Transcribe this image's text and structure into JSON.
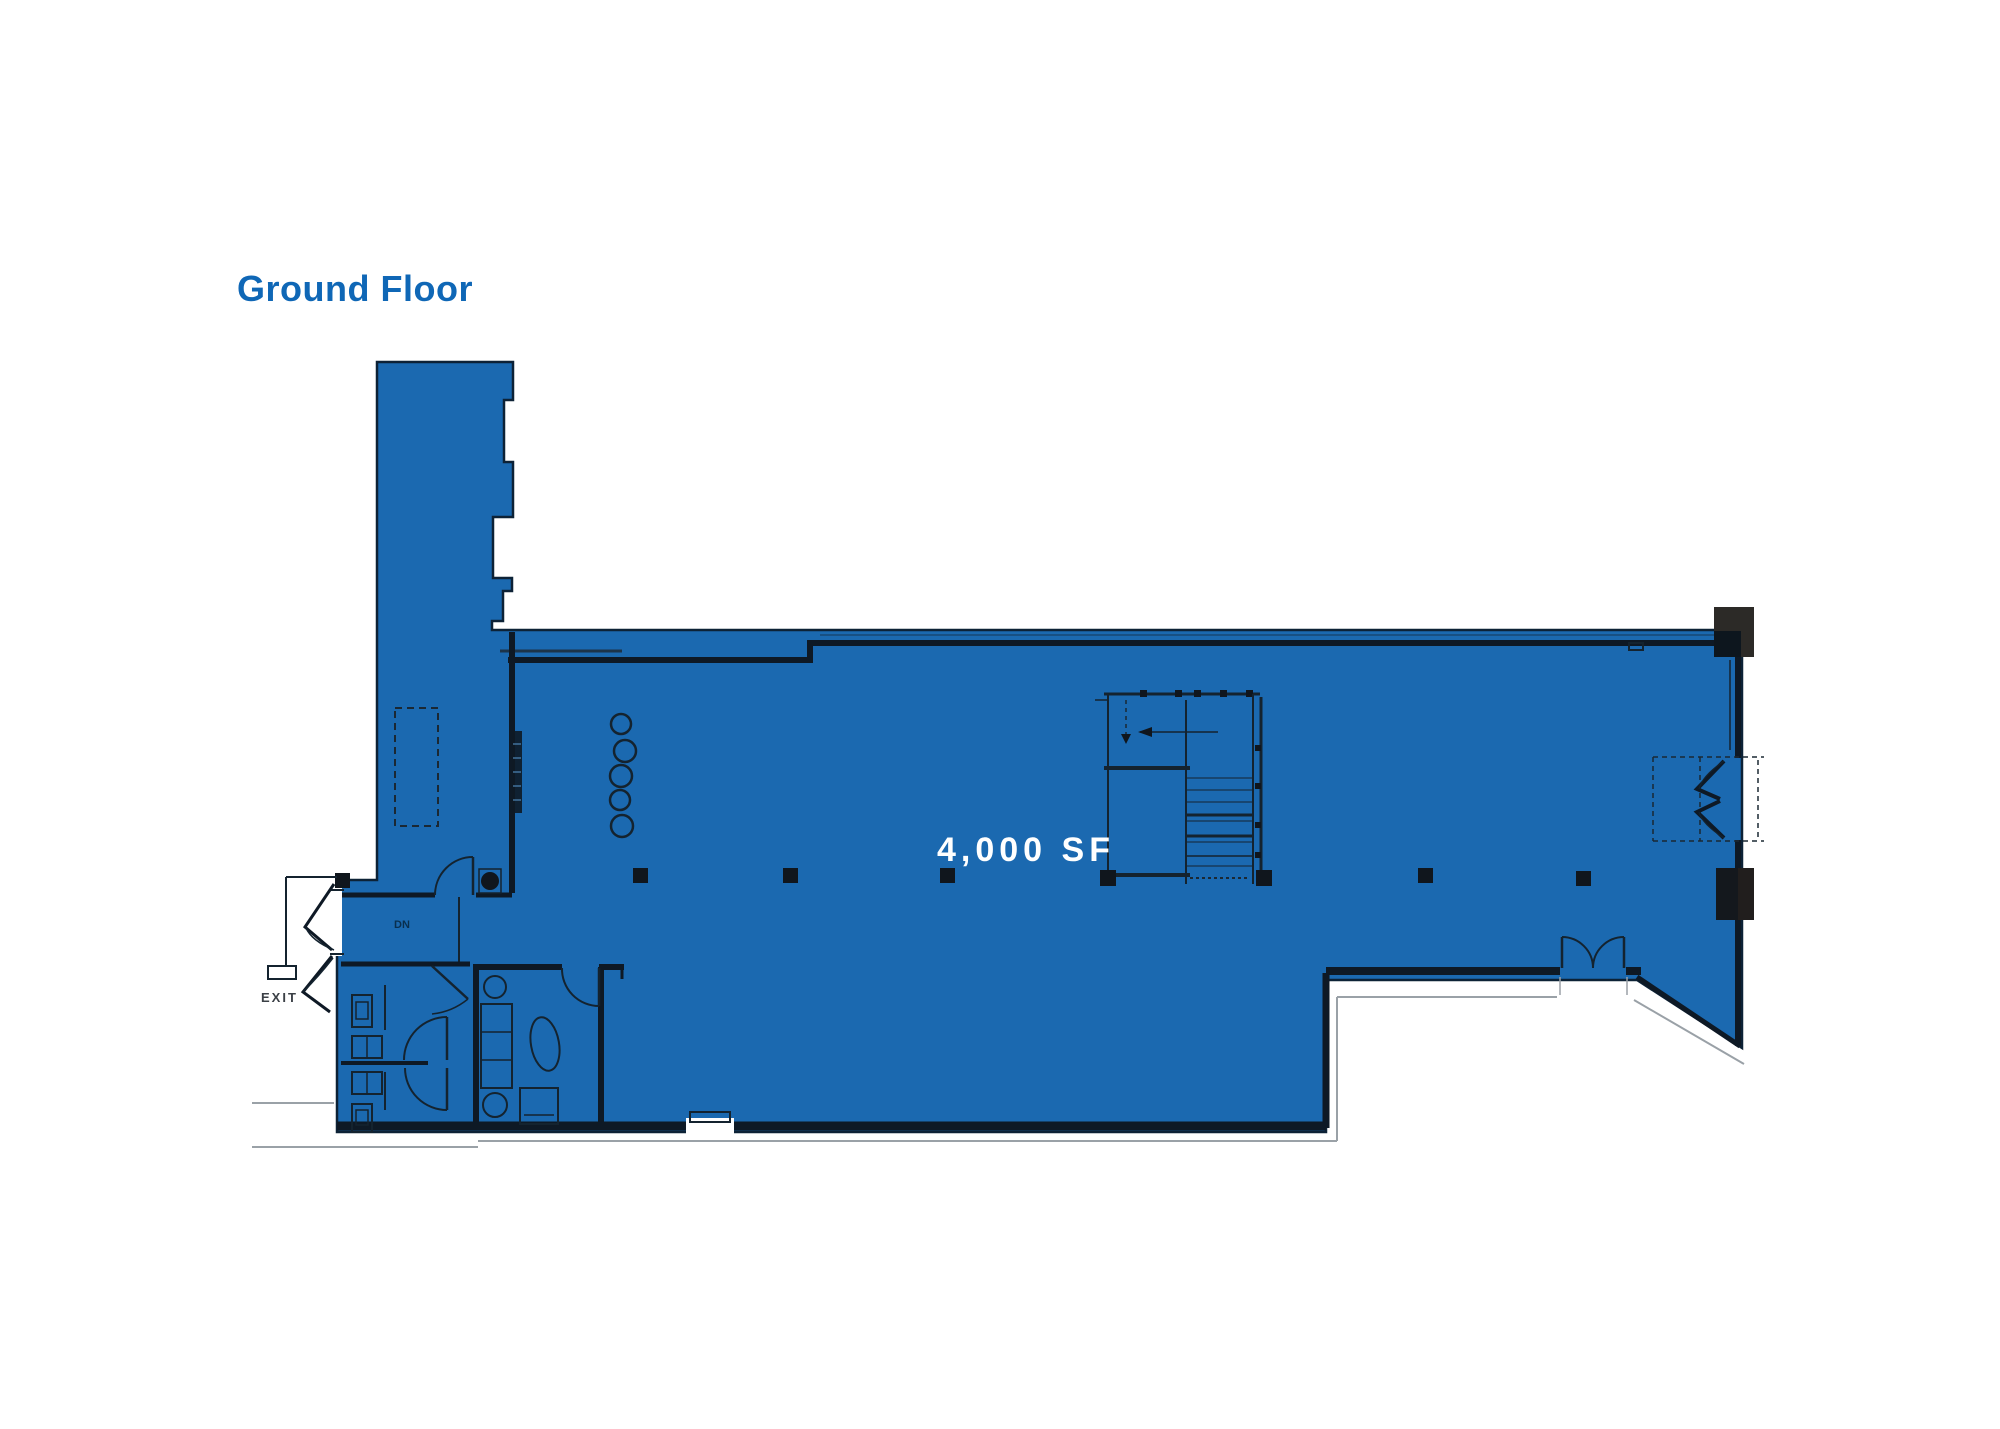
{
  "page": {
    "background_color": "#ffffff"
  },
  "title": {
    "label": "Ground Floor",
    "color": "#0f67b6"
  },
  "floor_plan": {
    "area_label": "4,000 SF",
    "area_label_color": "#ffffff",
    "fill_color": "#1b69b0",
    "wall_color": "#0e1925",
    "outline_color": "#9aa1a7",
    "column_color": "#10161d",
    "exit_label": "EXIT",
    "stair_label": "DN"
  }
}
